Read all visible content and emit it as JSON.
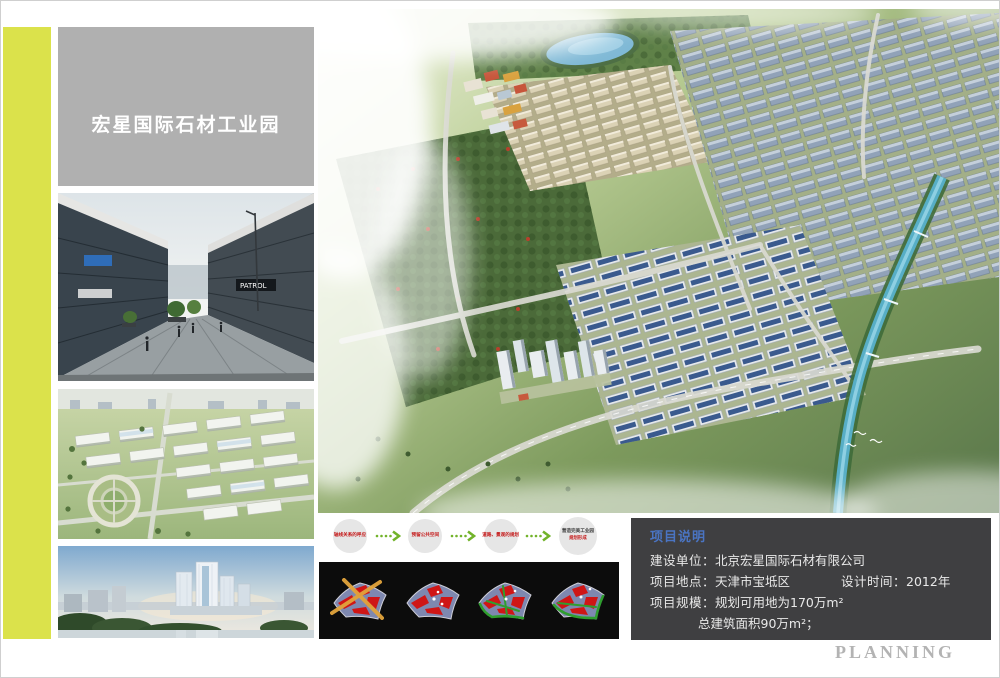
{
  "header": {
    "title": "宏星国际石材工业园"
  },
  "flow": {
    "steps": [
      {
        "label": "轴线关系的呼应"
      },
      {
        "label": "预留公共空间"
      },
      {
        "label": "道路、景观的规划"
      },
      {
        "label": "营造完美工业园",
        "sublabel": "规划形成"
      }
    ]
  },
  "photos": {
    "street_sign": "PATROL"
  },
  "project_info": {
    "heading": "项目说明",
    "rows": [
      {
        "label": "建设单位：",
        "value": "北京宏星国际石材有限公司"
      },
      {
        "label": "项目地点：",
        "value": "天津市宝坻区",
        "label2": "设计时间：",
        "value2": "2012年"
      },
      {
        "label": "项目规模：",
        "value": "规划可用地为170万m²"
      },
      {
        "label": "",
        "value": "总建筑面积90万m²；"
      }
    ]
  },
  "footer": {
    "brand": "PLANNING"
  },
  "colors": {
    "accent_bar": "#dbe24b",
    "title_box_bg": "#b0b0b0",
    "info_panel_bg": "#3f3f41",
    "heading_blue": "#4a74c2",
    "flow_text_red": "#c41616",
    "arrow_green": "#72b32a",
    "concept_box_bg": "#0c0c0c"
  }
}
